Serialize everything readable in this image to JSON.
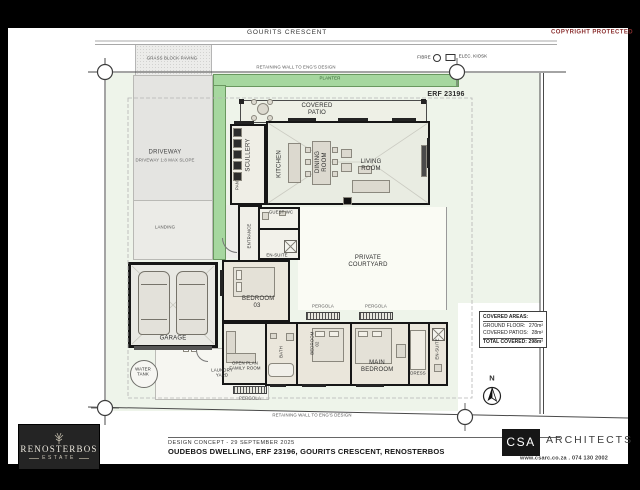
{
  "document": {
    "street_label": "GOURITS CRESCENT",
    "copyright": "COPYRIGHT PROTECTED",
    "erf_label": "ERF 23196",
    "legend": {
      "fibre": "FIBRE",
      "elec_kiosk": "ELEC. KIOSK"
    },
    "north_label": "N"
  },
  "site": {
    "retaining_wall_top": "RETAINING WALL TO ENG'S DESIGN",
    "retaining_wall_bottom": "RETAINING WALL TO ENG'S DESIGN",
    "planter": "PLANTER",
    "grass_paving": "GRASS BLOCK PAVING",
    "driveway": "DRIVEWAY",
    "driveway_note": "DRIVEWAY 1:8 MAX SLOPE",
    "landing": "LANDING",
    "courtyard": "PRIVATE COURTYARD",
    "laundry_yard": "LAUNDRY YARD",
    "water_tank": "WATER TANK",
    "pergola": "PERGOLA"
  },
  "rooms": {
    "covered_patio": "COVERED PATIO",
    "scullery": "SCULLERY",
    "pantry": "PANTRY",
    "kitchen": "KITCHEN",
    "dining": "DINING ROOM",
    "living": "LIVING ROOM",
    "entrance": "ENTRANCE",
    "guest_wc": "GUEST WC",
    "ensuite_bed3": "EN-SUITE",
    "bedroom3": "BEDROOM 03",
    "family_room": "OPEN PLAN FAMILY ROOM",
    "bath": "BATH",
    "bedroom2": "BEDROOM 02",
    "main_bedroom": "MAIN BEDROOM",
    "dress": "DRESS",
    "ensuite_main": "EN-SUITE",
    "garage": "GARAGE"
  },
  "areas_table": {
    "title": "COVERED AREAS:",
    "rows": [
      {
        "label": "GROUND FLOOR:",
        "value": "270m²"
      },
      {
        "label": "COVERED PATIOS:",
        "value": "28m²"
      }
    ],
    "total_label": "TOTAL COVERED:",
    "total_value": "298m²"
  },
  "title_block": {
    "concept_line": "DESIGN CONCEPT - 29 SEPTEMBER 2025",
    "project_line": "OUDEBOS DWELLING, ERF 23196, GOURITS CRESCENT, RENOSTERBOS"
  },
  "branding": {
    "estate_name": "RENOSTERBOS",
    "estate_sub": "ESTATE",
    "firm_abbr": "CSA",
    "firm_name": "ARCHITECTS",
    "firm_contact": "www.csarc.co.za . 074 130 2002"
  },
  "icons": {
    "north_arrow": "north-arrow-icon",
    "fibre_marker": "circle-marker-icon",
    "elec_kiosk_marker": "square-marker-icon",
    "estate_emblem": "plant-emblem-icon",
    "survey_marker": "circle-crosshair-icon"
  },
  "colors": {
    "planter_green": "#a6d79f",
    "lawn_green": "#eef4ea",
    "copyright_red": "#8a2f2f",
    "wall_black": "#141414",
    "logo_charcoal": "#232323"
  }
}
